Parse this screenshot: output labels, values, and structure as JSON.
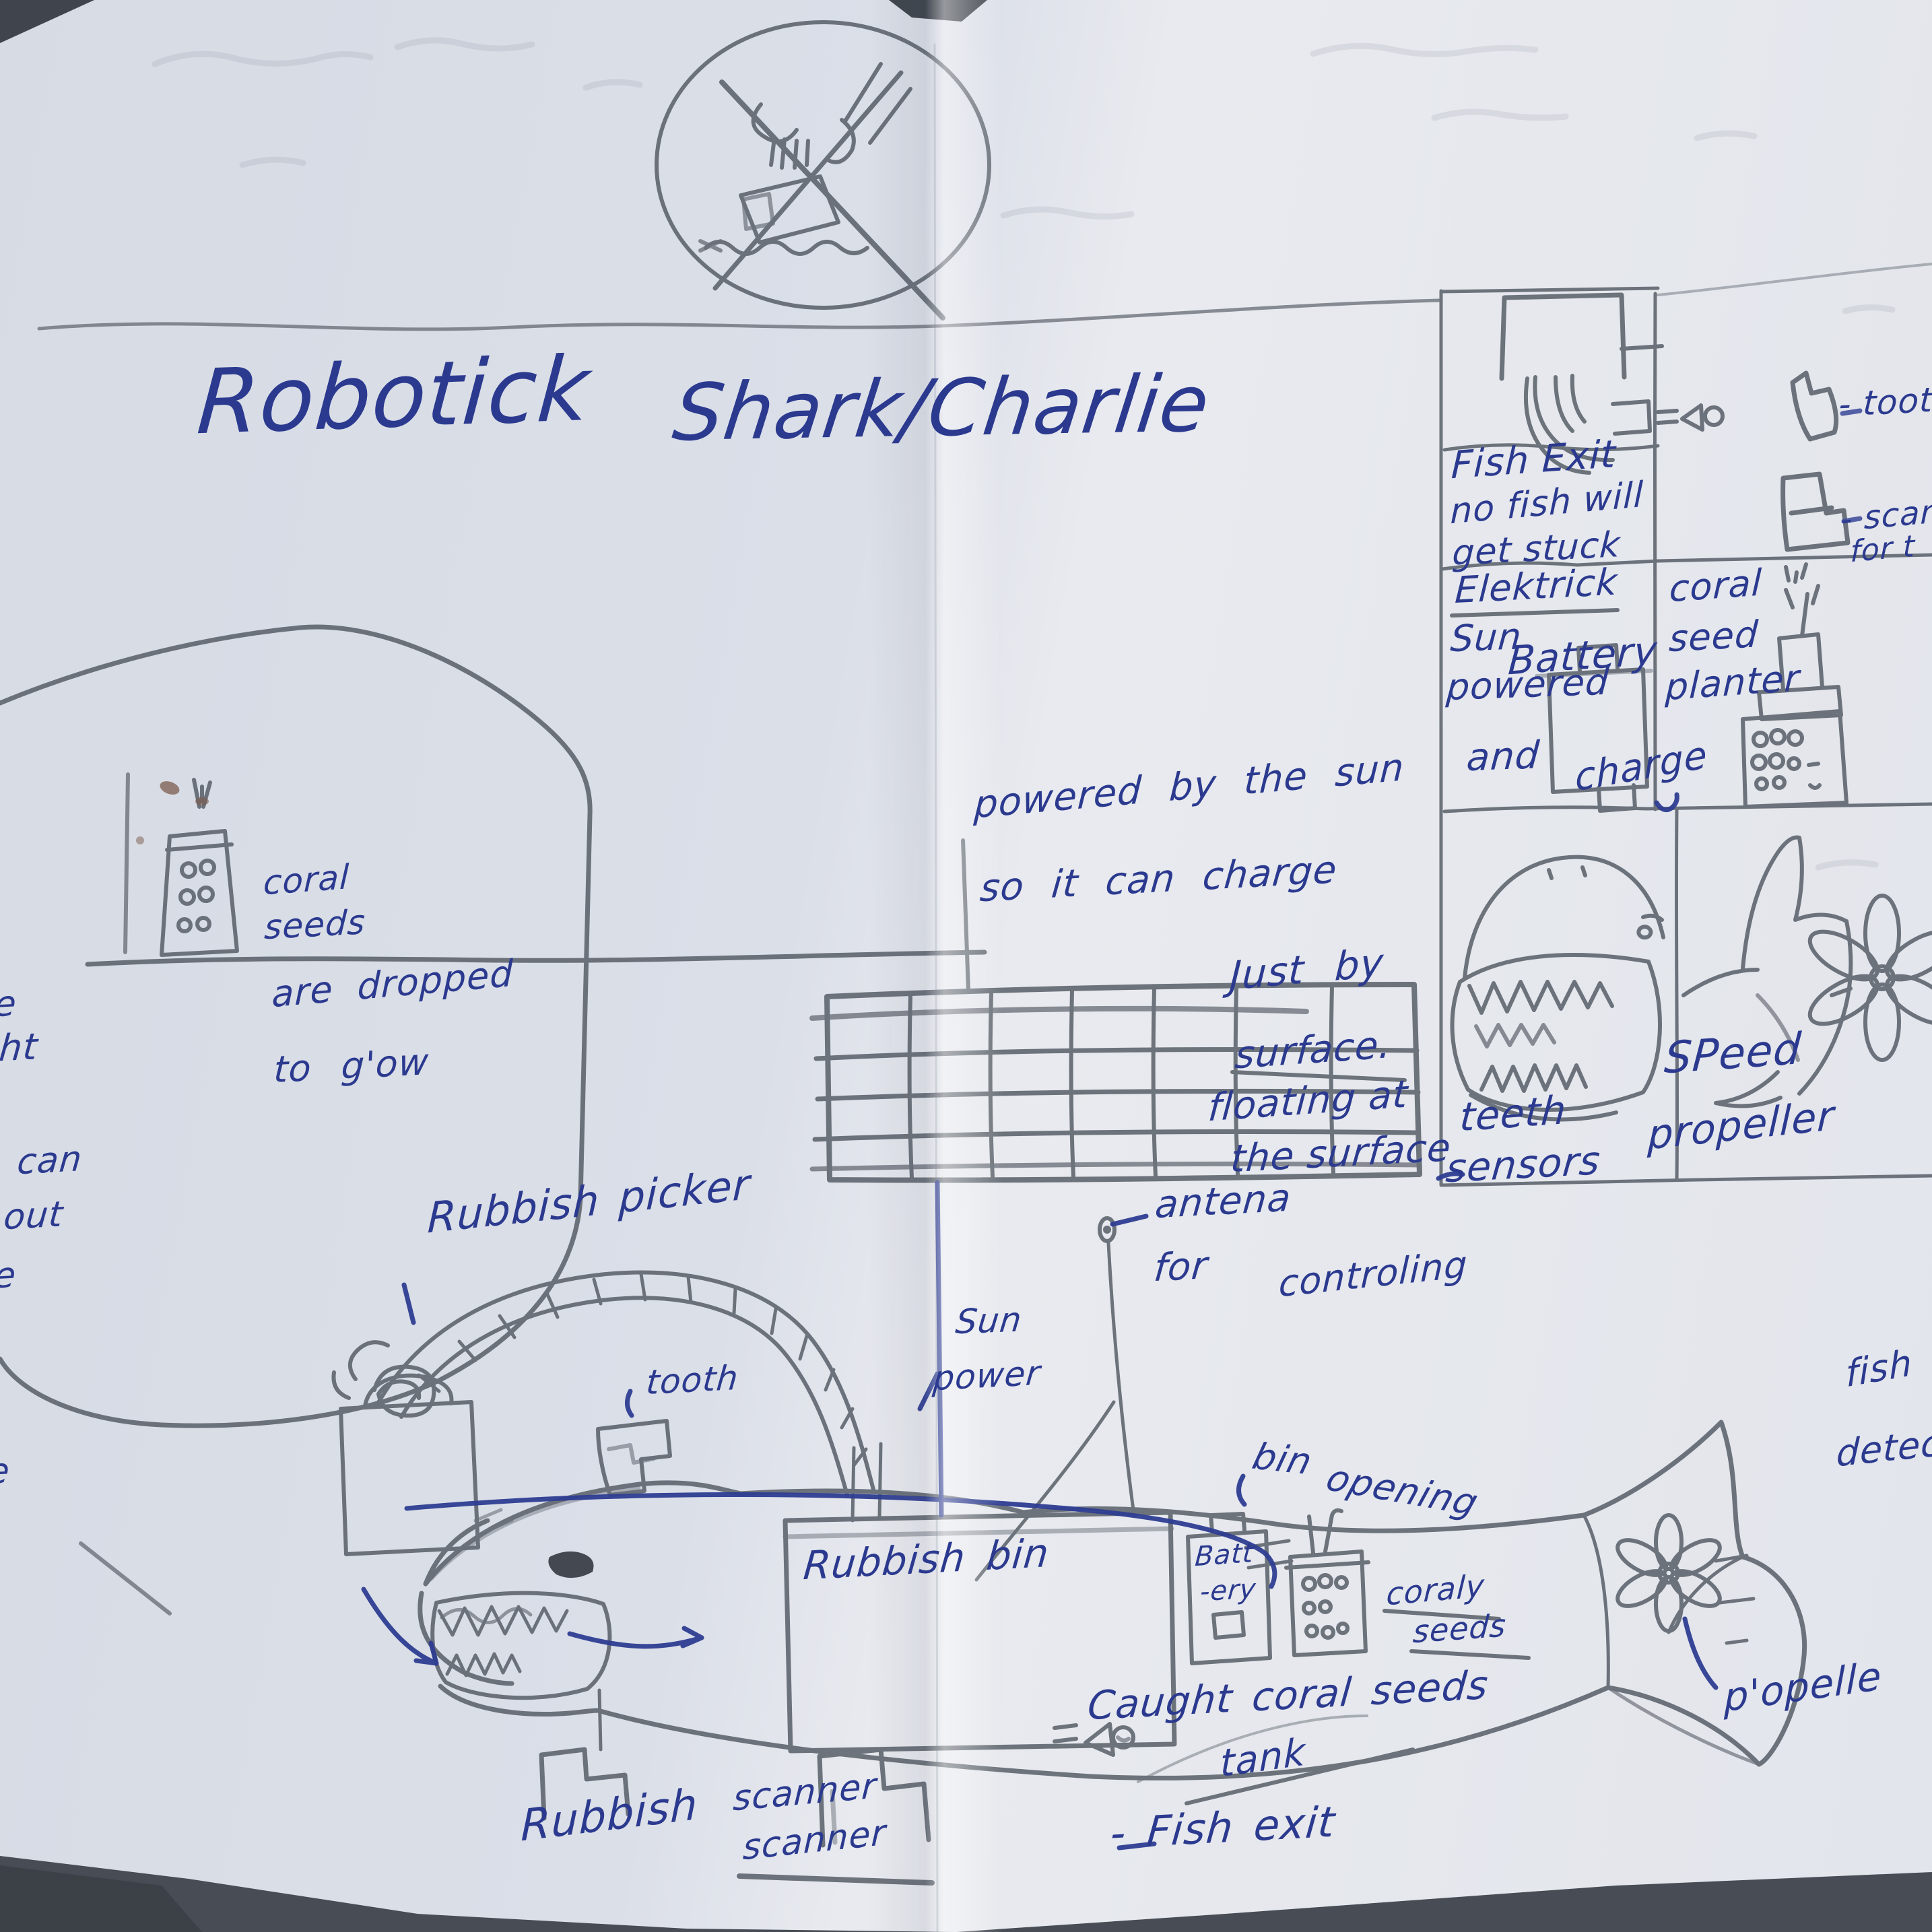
{
  "colors": {
    "ink": "#2b3a8f",
    "pencil": "#5c626c",
    "paper": "#dde1e9",
    "table": "#474c55"
  },
  "title": {
    "left": "Robotick",
    "right": "Shark/Charlie"
  },
  "legend": {
    "fish_exit": {
      "lines": [
        "Fish Exit",
        "no fish will",
        "get stuck"
      ]
    },
    "battery_cell": {
      "word1": "Elektrick",
      "word2": "Sun",
      "word3": "powered",
      "battery": "Battery",
      "and": "and",
      "charge": "charge"
    },
    "planter_cell": {
      "lines": [
        "coral",
        "seed",
        "planter"
      ]
    },
    "teeth_cell": {
      "line1": "teeth",
      "line2": "sensors"
    },
    "propeller_cell": {
      "line1": "SPeed",
      "line2": "propeller"
    },
    "tooth_key": "- tooth",
    "scan_key": {
      "line1": "- scan",
      "line2": "for  t"
    }
  },
  "solar": {
    "line1": "powered by the sun",
    "line2": "so it can charge"
  },
  "surface_note": {
    "l1": "Just by",
    "l2": "surface.",
    "l3": "floating at",
    "l4": "the  surface"
  },
  "coral_note": {
    "l1": "coral",
    "l2": "seeds",
    "l3": "are dropped",
    "l4": "to g'ow"
  },
  "left_edge_fragments": [
    "e",
    "ght",
    "can",
    "out",
    "le",
    "e"
  ],
  "labels": {
    "rubbish_picker": "Rubbish  picker",
    "tooth": "tooth",
    "sun_power": {
      "line1": "Sun",
      "line2": "power"
    },
    "antenna": {
      "line1": "antena",
      "line2": "for",
      "line3": "controling"
    },
    "bin_opening": {
      "word1": "bin",
      "word2": "opening"
    },
    "rubbish_bin": "Rubbish  bin",
    "battery": {
      "line1": "Batt",
      "line2": "-ery"
    },
    "coral_seeds_small": {
      "line1": "coraly",
      "line2": "seeds"
    },
    "caught": {
      "line1": "Caught coral  seeds",
      "line2": "tank"
    },
    "fish_exit": "- Fish   exit",
    "rubbish_scanner": {
      "word1": "Rubbish",
      "word2": "scanner",
      "word3": "scanner"
    },
    "propeller": "p'opelle",
    "fish_detector": {
      "line1": "fish",
      "line2": "detec"
    }
  }
}
